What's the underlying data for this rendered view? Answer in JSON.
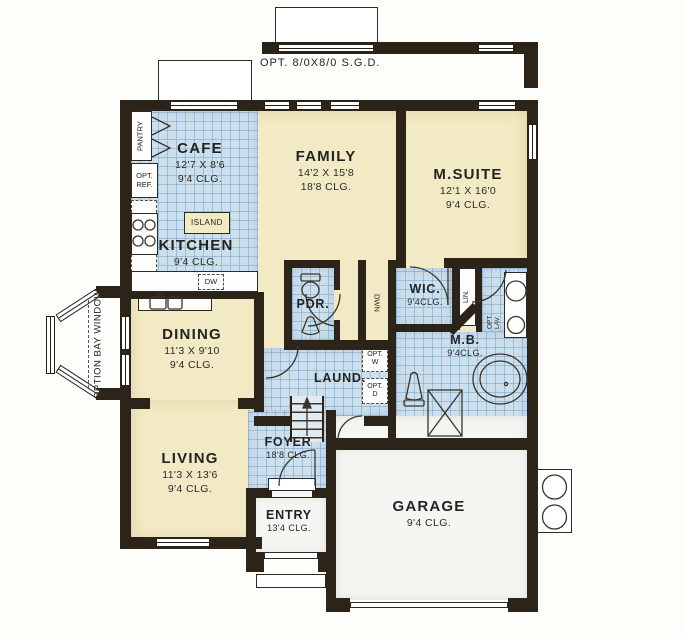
{
  "page": {
    "title": "Single-story floor plan"
  },
  "colors": {
    "wall": "#2d2419",
    "carpet_floor": "#f2eac4",
    "tile_floor": "#cbdfed",
    "porch_floor": "#f5f5f2",
    "paper": "#fdfdfa"
  },
  "annotations": {
    "opt_sgd": "OPT. 8/0X8/0 S.G.D.",
    "option_bay_window": "OPTION BAY WINDOW"
  },
  "rooms": {
    "cafe": {
      "name": "CAFE",
      "dims": "12'7 X 8'6",
      "ceiling": "9'4 CLG."
    },
    "kitchen": {
      "name": "KITCHEN",
      "ceiling": "9'4 CLG."
    },
    "family": {
      "name": "FAMILY",
      "dims": "14'2 X 15'8",
      "ceiling": "18'8 CLG."
    },
    "msuite": {
      "name": "M.SUITE",
      "dims": "12'1 X 16'0",
      "ceiling": "9'4 CLG."
    },
    "dining": {
      "name": "DINING",
      "dims": "11'3 X 9'10",
      "ceiling": "9'4 CLG."
    },
    "living": {
      "name": "LIVING",
      "dims": "11'3 X 13'6",
      "ceiling": "9'4 CLG."
    },
    "pdr": {
      "name": "PDR."
    },
    "wic": {
      "name": "WIC.",
      "ceiling": "9'4CLG."
    },
    "mb": {
      "name": "M.B.",
      "ceiling": "9'4CLG."
    },
    "laund": {
      "name": "LAUND."
    },
    "foyer": {
      "name": "FOYER",
      "ceiling": "18'8 CLG."
    },
    "entry": {
      "name": "ENTRY",
      "ceiling": "13'4 CLG."
    },
    "garage": {
      "name": "GARAGE",
      "ceiling": "9'4 CLG."
    }
  },
  "fixtures": {
    "pantry": "PANTRY",
    "opt_ref": "OPT.\nREF.",
    "island": "ISLAND",
    "dw": "DW",
    "dwn": "DWN",
    "lin": "LIN.",
    "opt_lav": "OPT.\nLAV.",
    "opt_w": "OPT.\nW",
    "opt_d": "OPT.\nD"
  }
}
